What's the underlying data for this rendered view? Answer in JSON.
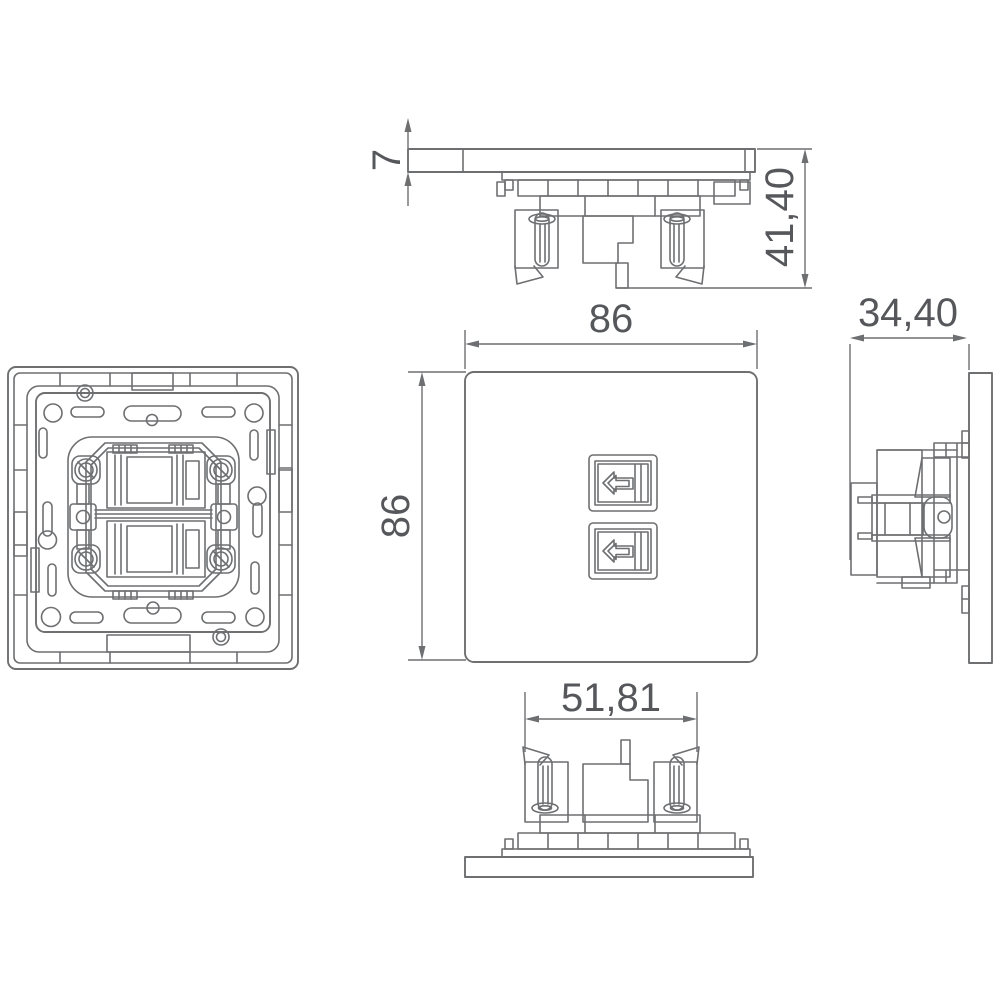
{
  "document": {
    "background": "#ffffff",
    "line_color": "#6e6f71",
    "text_color": "#56575b"
  },
  "dimensions": {
    "plate_thickness": "7",
    "total_depth": "41,40",
    "front_width": "86",
    "front_height": "86",
    "side_depth": "34,40",
    "mechanism_width": "51,81"
  }
}
